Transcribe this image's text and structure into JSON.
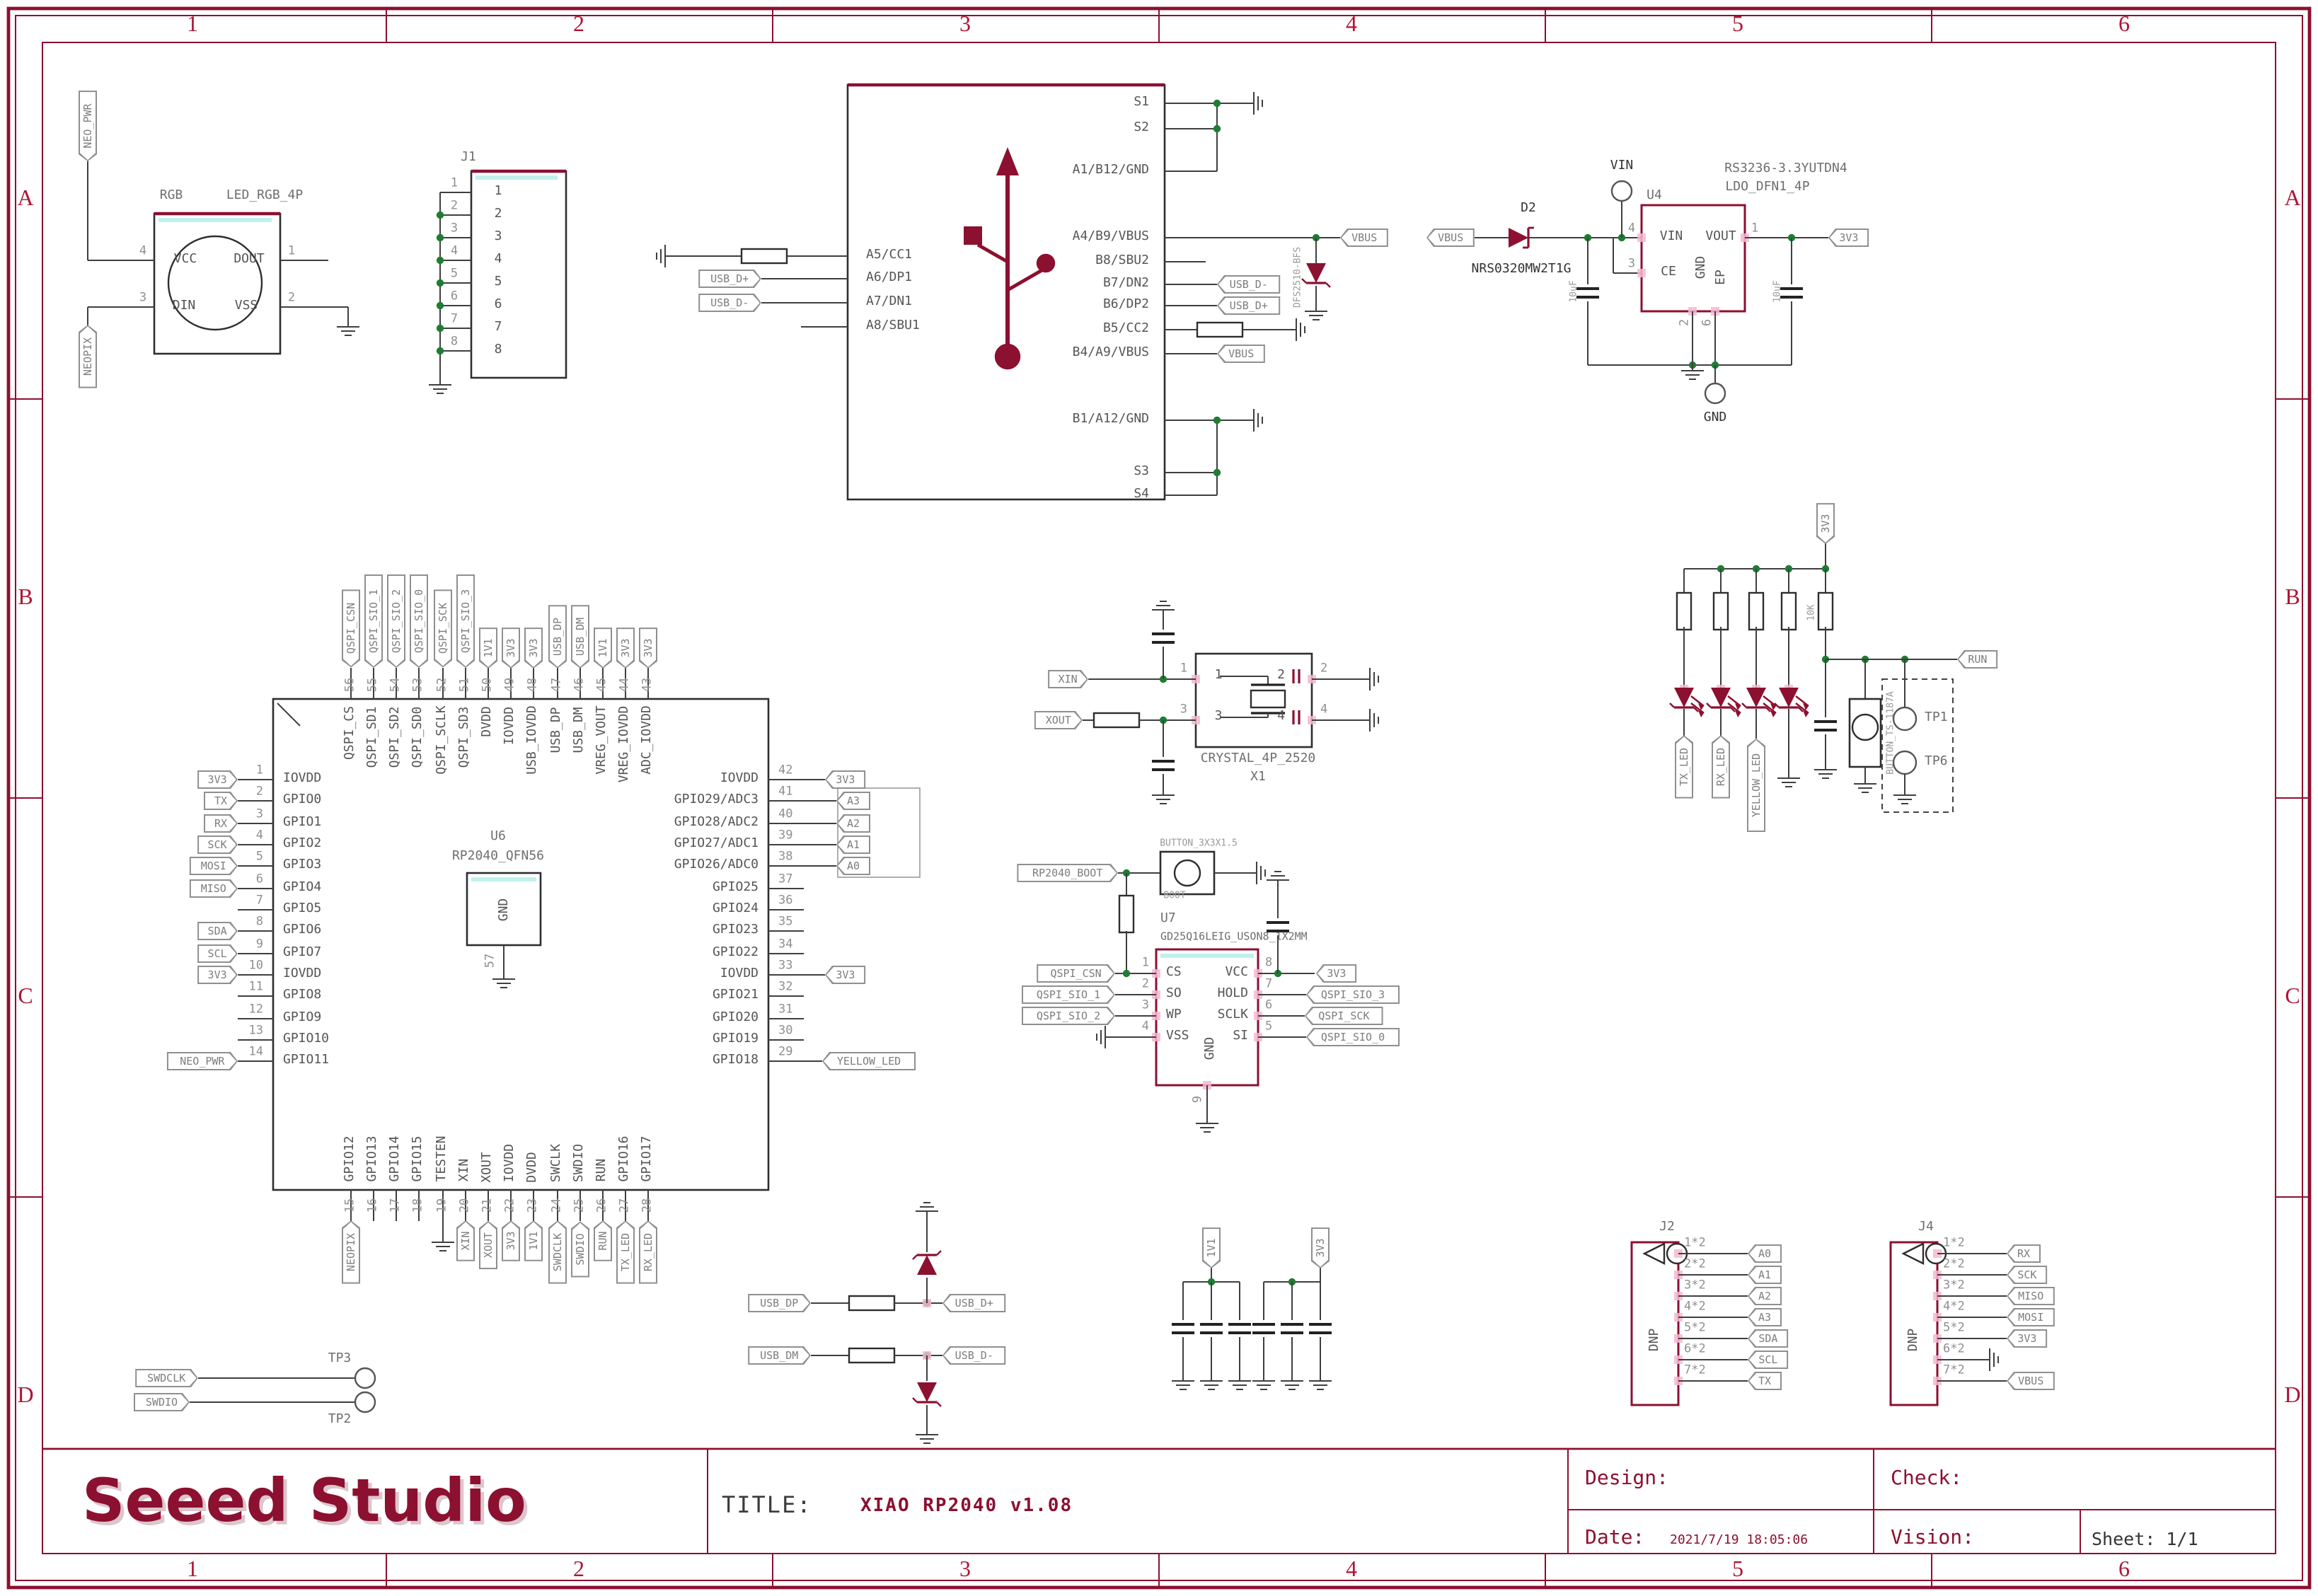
{
  "sheet": {
    "columns": [
      "1",
      "2",
      "3",
      "4",
      "5",
      "6"
    ],
    "rows": [
      "A",
      "B",
      "C",
      "D"
    ]
  },
  "title_block": {
    "logo": "Seeed Studio",
    "title_label": "TITLE:",
    "title": "XIAO RP2040 v1.08",
    "design_label": "Design:",
    "check_label": "Check:",
    "date_label": "Date:",
    "date": "2021/7/19 18:05:06",
    "vision_label": "Vision:",
    "sheet_label": "Sheet: 1/1"
  },
  "colors": {
    "accent": "#8c1030",
    "wire": "#3f3f3f",
    "junction": "#1e7d32",
    "pad": "#f6b8d2"
  },
  "components": {
    "rgb_led": {
      "refdes": "RGB",
      "part": "LED_RGB_4P",
      "pins": [
        {
          "num": "4",
          "name": "VCC",
          "net": "NEO_PWR"
        },
        {
          "num": "3",
          "name": "DIN",
          "net": "NEOPIX"
        },
        {
          "num": "1",
          "name": "DOUT",
          "net": ""
        },
        {
          "num": "2",
          "name": "VSS",
          "net": ""
        }
      ]
    },
    "j1": {
      "refdes": "J1",
      "pins": [
        "1",
        "2",
        "3",
        "4",
        "5",
        "6",
        "7",
        "8"
      ]
    },
    "usb": {
      "left": [
        "A5/CC1",
        "A6/DP1",
        "A7/DN1",
        "A8/SBU1"
      ],
      "left_nets": [
        "",
        "USB_D+",
        "USB_D-",
        ""
      ],
      "right": [
        "S1",
        "S2",
        "A1/B12/GND",
        "A4/B9/VBUS",
        "B8/SBU2",
        "B7/DN2",
        "B6/DP2",
        "B5/CC2",
        "B4/A9/VBUS",
        "B1/A12/GND",
        "S3",
        "S4"
      ],
      "right_nets": [
        "",
        "",
        "",
        "VBUS",
        "",
        "USB_D-",
        "USB_D+",
        "",
        "VBUS",
        "",
        "",
        ""
      ],
      "tvs_part": "DFS2510-BFS"
    },
    "power": {
      "input_net": "VBUS",
      "output_net": "3V3",
      "diode_refdes": "D2",
      "diode_part": "NRS0320MW2T1G",
      "vin_port": "VIN",
      "gnd_port": "GND",
      "cap_in": "10uF",
      "cap_out": "10uF",
      "regulator": {
        "refdes": "U4",
        "part1": "RS3236-3.3YUTDN4",
        "part2": "LDO_DFN1_4P",
        "pins": [
          {
            "num": "4",
            "name": "VIN"
          },
          {
            "num": "3",
            "name": "CE"
          },
          {
            "num": "1",
            "name": "VOUT"
          },
          {
            "num": "2",
            "name": "GND"
          },
          {
            "num": "6",
            "name": "EP"
          }
        ]
      }
    },
    "rp2040": {
      "refdes": "U6",
      "part": "RP2040_QFN56",
      "gnd_pad": {
        "pin": "57",
        "name": "GND"
      },
      "left": [
        {
          "pin": "1",
          "name": "IOVDD",
          "net": "3V3"
        },
        {
          "pin": "2",
          "name": "GPIO0",
          "net": "TX"
        },
        {
          "pin": "3",
          "name": "GPIO1",
          "net": "RX"
        },
        {
          "pin": "4",
          "name": "GPIO2",
          "net": "SCK"
        },
        {
          "pin": "5",
          "name": "GPIO3",
          "net": "MOSI"
        },
        {
          "pin": "6",
          "name": "GPIO4",
          "net": "MISO"
        },
        {
          "pin": "7",
          "name": "GPIO5",
          "net": ""
        },
        {
          "pin": "8",
          "name": "GPIO6",
          "net": "SDA"
        },
        {
          "pin": "9",
          "name": "GPIO7",
          "net": "SCL"
        },
        {
          "pin": "10",
          "name": "IOVDD",
          "net": "3V3"
        },
        {
          "pin": "11",
          "name": "GPIO8",
          "net": ""
        },
        {
          "pin": "12",
          "name": "GPIO9",
          "net": ""
        },
        {
          "pin": "13",
          "name": "GPIO10",
          "net": ""
        },
        {
          "pin": "14",
          "name": "GPIO11",
          "net": "NEO_PWR"
        }
      ],
      "right": [
        {
          "pin": "42",
          "name": "IOVDD",
          "net": "3V3"
        },
        {
          "pin": "41",
          "name": "GPIO29/ADC3",
          "net": "A3"
        },
        {
          "pin": "40",
          "name": "GPIO28/ADC2",
          "net": "A2"
        },
        {
          "pin": "39",
          "name": "GPIO27/ADC1",
          "net": "A1"
        },
        {
          "pin": "38",
          "name": "GPIO26/ADC0",
          "net": "A0"
        },
        {
          "pin": "37",
          "name": "GPIO25",
          "net": ""
        },
        {
          "pin": "36",
          "name": "GPIO24",
          "net": ""
        },
        {
          "pin": "35",
          "name": "GPIO23",
          "net": ""
        },
        {
          "pin": "34",
          "name": "GPIO22",
          "net": ""
        },
        {
          "pin": "33",
          "name": "IOVDD",
          "net": "3V3"
        },
        {
          "pin": "32",
          "name": "GPIO21",
          "net": ""
        },
        {
          "pin": "31",
          "name": "GPIO20",
          "net": ""
        },
        {
          "pin": "30",
          "name": "GPIO19",
          "net": ""
        },
        {
          "pin": "29",
          "name": "GPIO18",
          "net": "YELLOW_LED"
        }
      ],
      "top": [
        {
          "pin": "56",
          "name": "QSPI_CS",
          "net": "QSPI_CSN"
        },
        {
          "pin": "55",
          "name": "QSPI_SD1",
          "net": "QSPI_SIO_1"
        },
        {
          "pin": "54",
          "name": "QSPI_SD2",
          "net": "QSPI_SIO_2"
        },
        {
          "pin": "53",
          "name": "QSPI_SD0",
          "net": "QSPI_SIO_0"
        },
        {
          "pin": "52",
          "name": "QSPI_SCLK",
          "net": "QSPI_SCK"
        },
        {
          "pin": "51",
          "name": "QSPI_SD3",
          "net": "QSPI_SIO_3"
        },
        {
          "pin": "50",
          "name": "DVDD",
          "net": "1V1"
        },
        {
          "pin": "49",
          "name": "IOVDD",
          "net": "3V3"
        },
        {
          "pin": "48",
          "name": "USB_IOVDD",
          "net": "3V3"
        },
        {
          "pin": "47",
          "name": "USB_DP",
          "net": "USB_DP"
        },
        {
          "pin": "46",
          "name": "USB_DM",
          "net": "USB_DM"
        },
        {
          "pin": "45",
          "name": "VREG_VOUT",
          "net": "1V1"
        },
        {
          "pin": "44",
          "name": "VREG_IOVDD",
          "net": "3V3"
        },
        {
          "pin": "43",
          "name": "ADC_IOVDD",
          "net": "3V3"
        }
      ],
      "bottom": [
        {
          "pin": "15",
          "name": "GPIO12",
          "net": "NEOPIX"
        },
        {
          "pin": "16",
          "name": "GPIO13",
          "net": ""
        },
        {
          "pin": "17",
          "name": "GPIO14",
          "net": ""
        },
        {
          "pin": "18",
          "name": "GPIO15",
          "net": ""
        },
        {
          "pin": "19",
          "name": "TESTEN",
          "net": ""
        },
        {
          "pin": "20",
          "name": "XIN",
          "net": "XIN"
        },
        {
          "pin": "21",
          "name": "XOUT",
          "net": "XOUT"
        },
        {
          "pin": "22",
          "name": "IOVDD",
          "net": "3V3"
        },
        {
          "pin": "23",
          "name": "DVDD",
          "net": "1V1"
        },
        {
          "pin": "24",
          "name": "SWCLK",
          "net": "SWDCLK"
        },
        {
          "pin": "25",
          "name": "SWDIO",
          "net": "SWDIO"
        },
        {
          "pin": "26",
          "name": "RUN",
          "net": "RUN"
        },
        {
          "pin": "27",
          "name": "GPIO16",
          "net": "TX_LED"
        },
        {
          "pin": "28",
          "name": "GPIO17",
          "net": "RX_LED"
        }
      ]
    },
    "crystal": {
      "refdes": "X1",
      "part": "CRYSTAL_4P_2520",
      "pins": [
        "1",
        "2",
        "3",
        "4"
      ],
      "nets": [
        "XIN",
        "XOUT"
      ]
    },
    "boot": {
      "button_part": "BUTTON_3X3X1.5",
      "label": "BOOT",
      "net": "RP2040_BOOT"
    },
    "flash": {
      "refdes": "U7",
      "part": "GD25Q16LEIG_USON8_1X2MM",
      "left": [
        {
          "pin": "1",
          "name": "CS",
          "net": "QSPI_CSN"
        },
        {
          "pin": "2",
          "name": "SO",
          "net": "QSPI_SIO_1"
        },
        {
          "pin": "3",
          "name": "WP",
          "net": "QSPI_SIO_2"
        },
        {
          "pin": "4",
          "name": "VSS",
          "net": ""
        }
      ],
      "right": [
        {
          "pin": "8",
          "name": "VCC",
          "net": "3V3"
        },
        {
          "pin": "7",
          "name": "HOLD",
          "net": "QSPI_SIO_3"
        },
        {
          "pin": "6",
          "name": "SCLK",
          "net": "QSPI_SCK"
        },
        {
          "pin": "5",
          "name": "SI",
          "net": "QSPI_SIO_0"
        }
      ],
      "bottom": {
        "pin": "9",
        "name": "GND"
      }
    },
    "led_bank": {
      "supply_net": "3V3",
      "resistor_value": "10K",
      "nets": [
        "TX_LED",
        "RX_LED",
        "YELLOW_LED"
      ],
      "run_net": "RUN",
      "button_part": "BUTTON_TS-1187A",
      "tp1": "TP1",
      "tp6": "TP6"
    },
    "esd": {
      "in": [
        "USB_DP",
        "USB_DM"
      ],
      "out": [
        "USB_D+",
        "USB_D-"
      ]
    },
    "decoupling": {
      "nets": [
        "1V1",
        "3V3"
      ]
    },
    "j2": {
      "refdes": "J2",
      "dnp": "DNP",
      "rows": [
        {
          "pin": "1*2",
          "net": "A0"
        },
        {
          "pin": "2*2",
          "net": "A1"
        },
        {
          "pin": "3*2",
          "net": "A2"
        },
        {
          "pin": "4*2",
          "net": "A3"
        },
        {
          "pin": "5*2",
          "net": "SDA"
        },
        {
          "pin": "6*2",
          "net": "SCL"
        },
        {
          "pin": "7*2",
          "net": "TX"
        }
      ]
    },
    "j4": {
      "refdes": "J4",
      "dnp": "DNP",
      "rows": [
        {
          "pin": "1*2",
          "net": "RX"
        },
        {
          "pin": "2*2",
          "net": "SCK"
        },
        {
          "pin": "3*2",
          "net": "MISO"
        },
        {
          "pin": "4*2",
          "net": "MOSI"
        },
        {
          "pin": "5*2",
          "net": "3V3"
        },
        {
          "pin": "6*2",
          "net": ""
        },
        {
          "pin": "7*2",
          "net": "VBUS"
        }
      ]
    },
    "testpoints": {
      "tp3": "TP3",
      "tp2": "TP2",
      "nets": [
        "SWDCLK",
        "SWDIO"
      ]
    }
  }
}
